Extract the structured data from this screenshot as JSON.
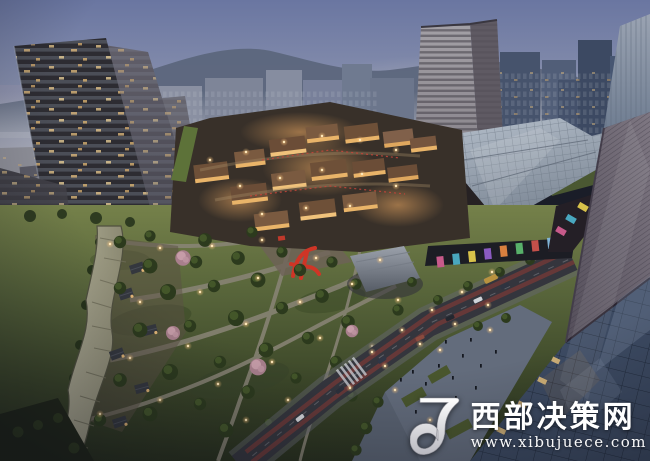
{
  "scene": {
    "type": "architectural aerial rendering",
    "time_of_day": "dusk",
    "description": "Aerial dusk rendering of a mixed-use development: leaning high-rise towers on the left, a shopping mall with bronze and glass roofs beside a mid-rise tower at center-right, a warmly lit low-rise retail village in the middle, a landscaped park with winding paths, cherry-blossom trees and a red sculpture, tree-lined roads with traffic, a pedestrian plaza, and a large glass office tower filling the right foreground; hazy mountains and a city skyline sit on the horizon."
  },
  "watermark": {
    "site_name": "西部决策网",
    "site_url": "www.xibujuece.com",
    "logo_icon": "stylized-J-monogram",
    "text_color": "#ffffff"
  },
  "palette": {
    "sky_top": "#6a76a1",
    "sky_horizon": "#b6b6bd",
    "mountain": "#5c667c",
    "tower_dark": "#2d2c32",
    "window_warm": "#ecca8c",
    "mall_bronze": "#8a6f4e",
    "mall_glass": "#b3bdc9",
    "park_light": "#75814a",
    "park_dark": "#28301d",
    "blossom_pink": "#c9a0ab",
    "sculpture_red": "#cf3526",
    "glass_tower": "#3c4a62",
    "road": "#34353d",
    "lamp_glow": "#ffc87e"
  }
}
